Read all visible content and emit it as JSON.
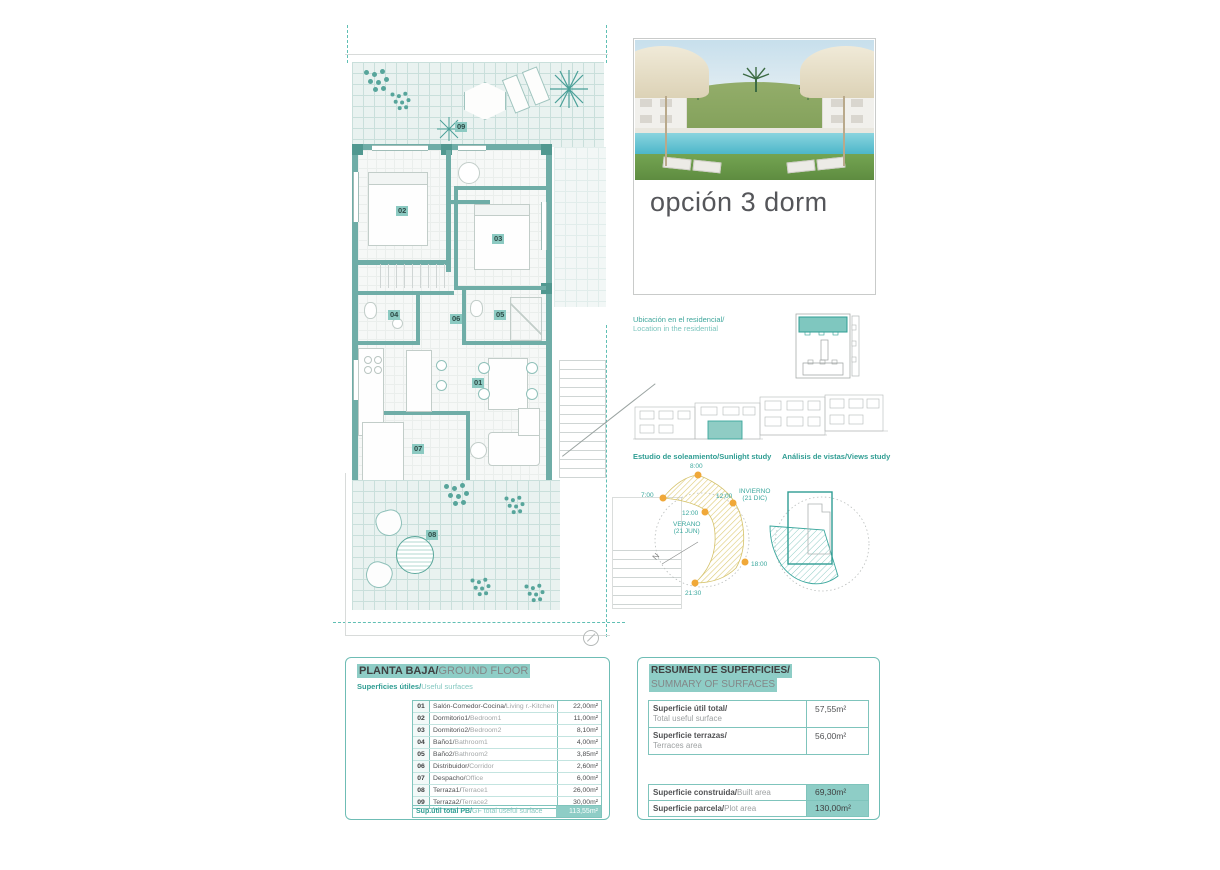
{
  "colors": {
    "accent_teal": "#3aa79d",
    "wall_teal": "#6fada7",
    "highlight_teal": "#8ecdc6",
    "sun_dot_orange": "#f0a838",
    "hatch_yellow": "#ddca74"
  },
  "photo_card": {
    "caption": "opción 3 dorm"
  },
  "location": {
    "es": "Ubicación en el residencial/",
    "en": "Location in the residential"
  },
  "studies": {
    "sunlight": "Estudio de soleamiento/Sunlight study",
    "views": "Análisis de vistas/Views study"
  },
  "sun_diagram": {
    "t_top": "8:00",
    "t_left": "7:00",
    "t_summer_noon": "12:00",
    "t_winter_noon": "12:00",
    "t_evening": "18:00",
    "t_night": "21:30",
    "summer": "VERANO\n(21 JUN)",
    "winter": "INVIERNO\n(21 DIC)",
    "north": "N"
  },
  "plan": {
    "rooms": {
      "r01": "01",
      "r02": "02",
      "r03": "03",
      "r04": "04",
      "r05": "05",
      "r06": "06",
      "r07": "07",
      "r08": "08",
      "r09": "09"
    }
  },
  "ground_floor_table": {
    "title_es": "PLANTA BAJA/",
    "title_en": "GROUND FLOOR",
    "subtitle_es": "Superficies útiles/",
    "subtitle_en": "Useful surfaces",
    "rows": [
      {
        "num": "01",
        "es": "Salón-Comedor-Cocina/",
        "en": "Living r.-Kitchen",
        "value": "22,00m²"
      },
      {
        "num": "02",
        "es": "Dormitorio1/",
        "en": "Bedroom1",
        "value": "11,00m²"
      },
      {
        "num": "03",
        "es": "Dormitorio2/",
        "en": "Bedroom2",
        "value": "8,10m²"
      },
      {
        "num": "04",
        "es": "Baño1/",
        "en": "Bathroom1",
        "value": "4,00m²"
      },
      {
        "num": "05",
        "es": "Baño2/",
        "en": "Bathroom2",
        "value": "3,85m²"
      },
      {
        "num": "06",
        "es": "Distribuidor/",
        "en": "Corridor",
        "value": "2,60m²"
      },
      {
        "num": "07",
        "es": "Despacho/",
        "en": "Office",
        "value": "6,00m²"
      },
      {
        "num": "08",
        "es": "Terraza1/",
        "en": "Terrace1",
        "value": "26,00m²"
      },
      {
        "num": "09",
        "es": "Terraza2/",
        "en": "Terrace2",
        "value": "30,00m²"
      }
    ],
    "total_es": "Sup.útil total PB/",
    "total_en": "GF total useful surface",
    "total_value": "113,55m²"
  },
  "summary_table": {
    "title_es": "RESUMEN DE SUPERFICIES/",
    "title_en": "SUMMARY OF SURFACES",
    "useful": {
      "es": "Superficie útil total/",
      "en": "Total useful surface",
      "value": "57,55m²"
    },
    "terraces": {
      "es": "Superficie terrazas/",
      "en": "Terraces area",
      "value": "56,00m²"
    },
    "built": {
      "es": "Superficie construida/",
      "en": "Built area",
      "value": "69,30m²"
    },
    "plot": {
      "es": "Superficie parcela/",
      "en": "Plot area",
      "value": "130,00m²"
    }
  }
}
